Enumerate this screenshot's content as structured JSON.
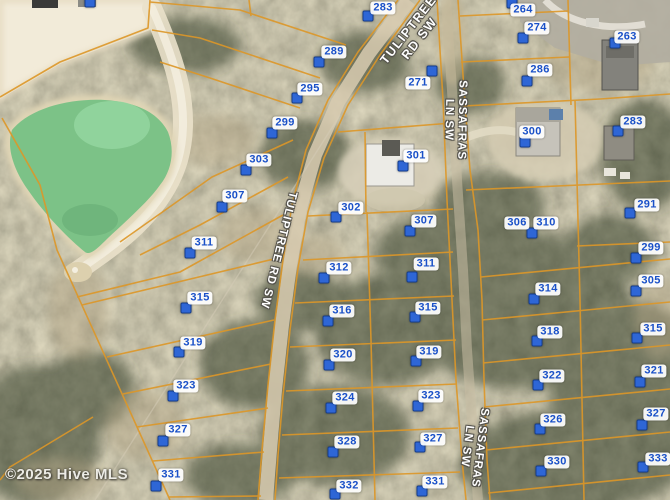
{
  "map": {
    "copyright": "©2025 Hive MLS",
    "colors": {
      "parcel_line": "#dd9728",
      "marker_fill": "#2e66d6",
      "marker_border": "#163f8f",
      "lot_label_text": "#1950c8",
      "lot_label_bg": "#ffffff",
      "road_label_text": "#ffffff",
      "pond": "#7cc287",
      "sand": "#f2ebd9"
    },
    "road_labels": [
      {
        "id": "tuliptree-top",
        "lines": [
          "TULIPTREE",
          "RD SW"
        ],
        "x": 414,
        "y": 34,
        "rotate": -52,
        "size": 12.5,
        "spacing": 1.5
      },
      {
        "id": "tuliptree-mid",
        "lines": [
          "TULIPTREE RD SW"
        ],
        "x": 278,
        "y": 250,
        "rotate": 104,
        "size": 11.5,
        "spacing": 1
      },
      {
        "id": "sassafras-top",
        "lines": [
          "SASSAFRAS",
          "LN SW"
        ],
        "x": 455,
        "y": 120,
        "rotate": 91,
        "size": 11.5,
        "spacing": 1
      },
      {
        "id": "sassafras-bottom",
        "lines": [
          "SASSAFRAS",
          "LN SW"
        ],
        "x": 473,
        "y": 447,
        "rotate": 97,
        "size": 11.5,
        "spacing": 1
      }
    ],
    "lots": [
      {
        "num": "283",
        "label": {
          "x": 383,
          "y": 8
        },
        "marker": {
          "x": 368,
          "y": 16
        }
      },
      {
        "num": "289",
        "label": {
          "x": 334,
          "y": 52
        },
        "marker": {
          "x": 319,
          "y": 62
        }
      },
      {
        "num": "295",
        "label": {
          "x": 310,
          "y": 89
        },
        "marker": {
          "x": 297,
          "y": 98
        }
      },
      {
        "num": "299",
        "label": {
          "x": 285,
          "y": 123
        },
        "marker": {
          "x": 272,
          "y": 133
        }
      },
      {
        "num": "303",
        "label": {
          "x": 259,
          "y": 160
        },
        "marker": {
          "x": 246,
          "y": 170
        }
      },
      {
        "num": "307",
        "label": {
          "x": 235,
          "y": 196
        },
        "marker": {
          "x": 222,
          "y": 207
        }
      },
      {
        "num": "311",
        "label": {
          "x": 204,
          "y": 243
        },
        "marker": {
          "x": 190,
          "y": 253
        }
      },
      {
        "num": "315",
        "label": {
          "x": 200,
          "y": 298
        },
        "marker": {
          "x": 186,
          "y": 308
        }
      },
      {
        "num": "319",
        "label": {
          "x": 193,
          "y": 343
        },
        "marker": {
          "x": 179,
          "y": 352
        }
      },
      {
        "num": "323",
        "label": {
          "x": 186,
          "y": 386
        },
        "marker": {
          "x": 173,
          "y": 396
        }
      },
      {
        "num": "327",
        "label": {
          "x": 178,
          "y": 430
        },
        "marker": {
          "x": 163,
          "y": 441
        }
      },
      {
        "num": "331",
        "label": {
          "x": 171,
          "y": 475
        },
        "marker": {
          "x": 156,
          "y": 486
        }
      },
      {
        "num": "271",
        "label": {
          "x": 418,
          "y": 83
        },
        "marker": {
          "x": 432,
          "y": 71
        }
      },
      {
        "num": "302",
        "label": {
          "x": 351,
          "y": 208
        },
        "marker": {
          "x": 336,
          "y": 217
        }
      },
      {
        "num": "312",
        "label": {
          "x": 339,
          "y": 268
        },
        "marker": {
          "x": 324,
          "y": 278
        }
      },
      {
        "num": "316",
        "label": {
          "x": 342,
          "y": 311
        },
        "marker": {
          "x": 328,
          "y": 321
        }
      },
      {
        "num": "320",
        "label": {
          "x": 343,
          "y": 355
        },
        "marker": {
          "x": 329,
          "y": 365
        }
      },
      {
        "num": "324",
        "label": {
          "x": 345,
          "y": 398
        },
        "marker": {
          "x": 331,
          "y": 408
        }
      },
      {
        "num": "328",
        "label": {
          "x": 347,
          "y": 442
        },
        "marker": {
          "x": 333,
          "y": 452
        }
      },
      {
        "num": "332",
        "label": {
          "x": 349,
          "y": 486
        },
        "marker": {
          "x": 335,
          "y": 494
        }
      },
      {
        "num": "301",
        "label": {
          "x": 416,
          "y": 156
        },
        "marker": {
          "x": 403,
          "y": 166
        }
      },
      {
        "num": "307",
        "label": {
          "x": 424,
          "y": 221
        },
        "marker": {
          "x": 410,
          "y": 231
        }
      },
      {
        "num": "311",
        "label": {
          "x": 426,
          "y": 264
        },
        "marker": {
          "x": 412,
          "y": 277
        }
      },
      {
        "num": "315",
        "label": {
          "x": 428,
          "y": 308
        },
        "marker": {
          "x": 415,
          "y": 317
        }
      },
      {
        "num": "319",
        "label": {
          "x": 429,
          "y": 352
        },
        "marker": {
          "x": 416,
          "y": 361
        }
      },
      {
        "num": "323",
        "label": {
          "x": 431,
          "y": 396
        },
        "marker": {
          "x": 418,
          "y": 406
        }
      },
      {
        "num": "327",
        "label": {
          "x": 433,
          "y": 439
        },
        "marker": {
          "x": 420,
          "y": 447
        }
      },
      {
        "num": "331",
        "label": {
          "x": 435,
          "y": 482
        },
        "marker": {
          "x": 422,
          "y": 491
        }
      },
      {
        "num": "264",
        "label": {
          "x": 523,
          "y": 10
        },
        "marker": {
          "x": 512,
          "y": 3
        }
      },
      {
        "num": "274",
        "label": {
          "x": 537,
          "y": 28
        },
        "marker": {
          "x": 523,
          "y": 38
        }
      },
      {
        "num": "263",
        "label": {
          "x": 627,
          "y": 37
        },
        "marker": {
          "x": 615,
          "y": 43
        }
      },
      {
        "num": "286",
        "label": {
          "x": 540,
          "y": 70
        },
        "marker": {
          "x": 527,
          "y": 81
        }
      },
      {
        "num": "300",
        "label": {
          "x": 532,
          "y": 132
        },
        "marker": {
          "x": 525,
          "y": 142
        }
      },
      {
        "num": "283",
        "label": {
          "x": 633,
          "y": 122
        },
        "marker": {
          "x": 618,
          "y": 131
        }
      },
      {
        "num": "306",
        "label": {
          "x": 517,
          "y": 223
        },
        "marker": null
      },
      {
        "num": "310",
        "label": {
          "x": 546,
          "y": 223
        },
        "marker": {
          "x": 532,
          "y": 233
        }
      },
      {
        "num": "291",
        "label": {
          "x": 647,
          "y": 205
        },
        "marker": {
          "x": 630,
          "y": 213
        }
      },
      {
        "num": "299",
        "label": {
          "x": 651,
          "y": 248
        },
        "marker": {
          "x": 636,
          "y": 258
        }
      },
      {
        "num": "314",
        "label": {
          "x": 548,
          "y": 289
        },
        "marker": {
          "x": 534,
          "y": 299
        }
      },
      {
        "num": "318",
        "label": {
          "x": 550,
          "y": 332
        },
        "marker": {
          "x": 537,
          "y": 341
        }
      },
      {
        "num": "322",
        "label": {
          "x": 552,
          "y": 376
        },
        "marker": {
          "x": 538,
          "y": 385
        }
      },
      {
        "num": "326",
        "label": {
          "x": 553,
          "y": 420
        },
        "marker": {
          "x": 540,
          "y": 429
        }
      },
      {
        "num": "330",
        "label": {
          "x": 557,
          "y": 462
        },
        "marker": {
          "x": 541,
          "y": 471
        }
      },
      {
        "num": "305",
        "label": {
          "x": 651,
          "y": 281
        },
        "marker": {
          "x": 636,
          "y": 291
        }
      },
      {
        "num": "315",
        "label": {
          "x": 653,
          "y": 329
        },
        "marker": {
          "x": 637,
          "y": 338
        }
      },
      {
        "num": "321",
        "label": {
          "x": 654,
          "y": 371
        },
        "marker": {
          "x": 640,
          "y": 382
        }
      },
      {
        "num": "327",
        "label": {
          "x": 656,
          "y": 414
        },
        "marker": {
          "x": 642,
          "y": 425
        }
      },
      {
        "num": "333",
        "label": {
          "x": 658,
          "y": 459
        },
        "marker": {
          "x": 643,
          "y": 467
        }
      }
    ],
    "extra_markers": [
      {
        "x": 90,
        "y": 2
      }
    ]
  }
}
